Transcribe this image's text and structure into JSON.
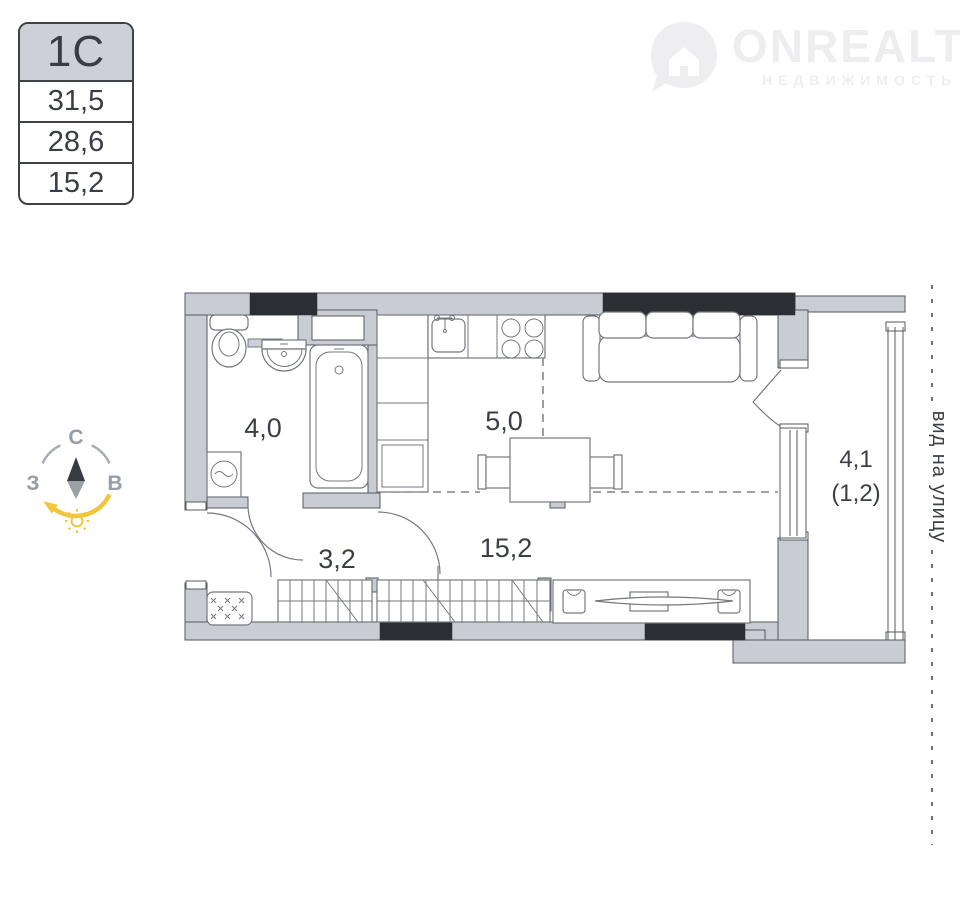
{
  "info_table": {
    "unit_type": "1С",
    "rows": [
      "31,5",
      "28,6",
      "15,2"
    ]
  },
  "logo": {
    "brand": "ONREALT",
    "tagline": "НЕДВИЖИМОСТЬ"
  },
  "compass": {
    "north": "С",
    "west": "З",
    "east": "В"
  },
  "plan": {
    "areas": {
      "bathroom": "4,0",
      "kitchen": "5,0",
      "hallway": "3,2",
      "living": "15,2",
      "balcony": "4,1",
      "balcony_reduced": "(1,2)"
    },
    "street_view": "вид на улицу"
  },
  "colors": {
    "wall": "#c9ccd3",
    "wall_outline": "#54585f",
    "black_wall": "#2b2e33",
    "furniture_line": "#74787f",
    "label_text": "#3b3f45",
    "accent_yellow": "#f2c63c",
    "compass_gray": "#9aa0a8",
    "table_header_bg": "#cdd0d6",
    "logo_watermark": "#eeeef1"
  }
}
